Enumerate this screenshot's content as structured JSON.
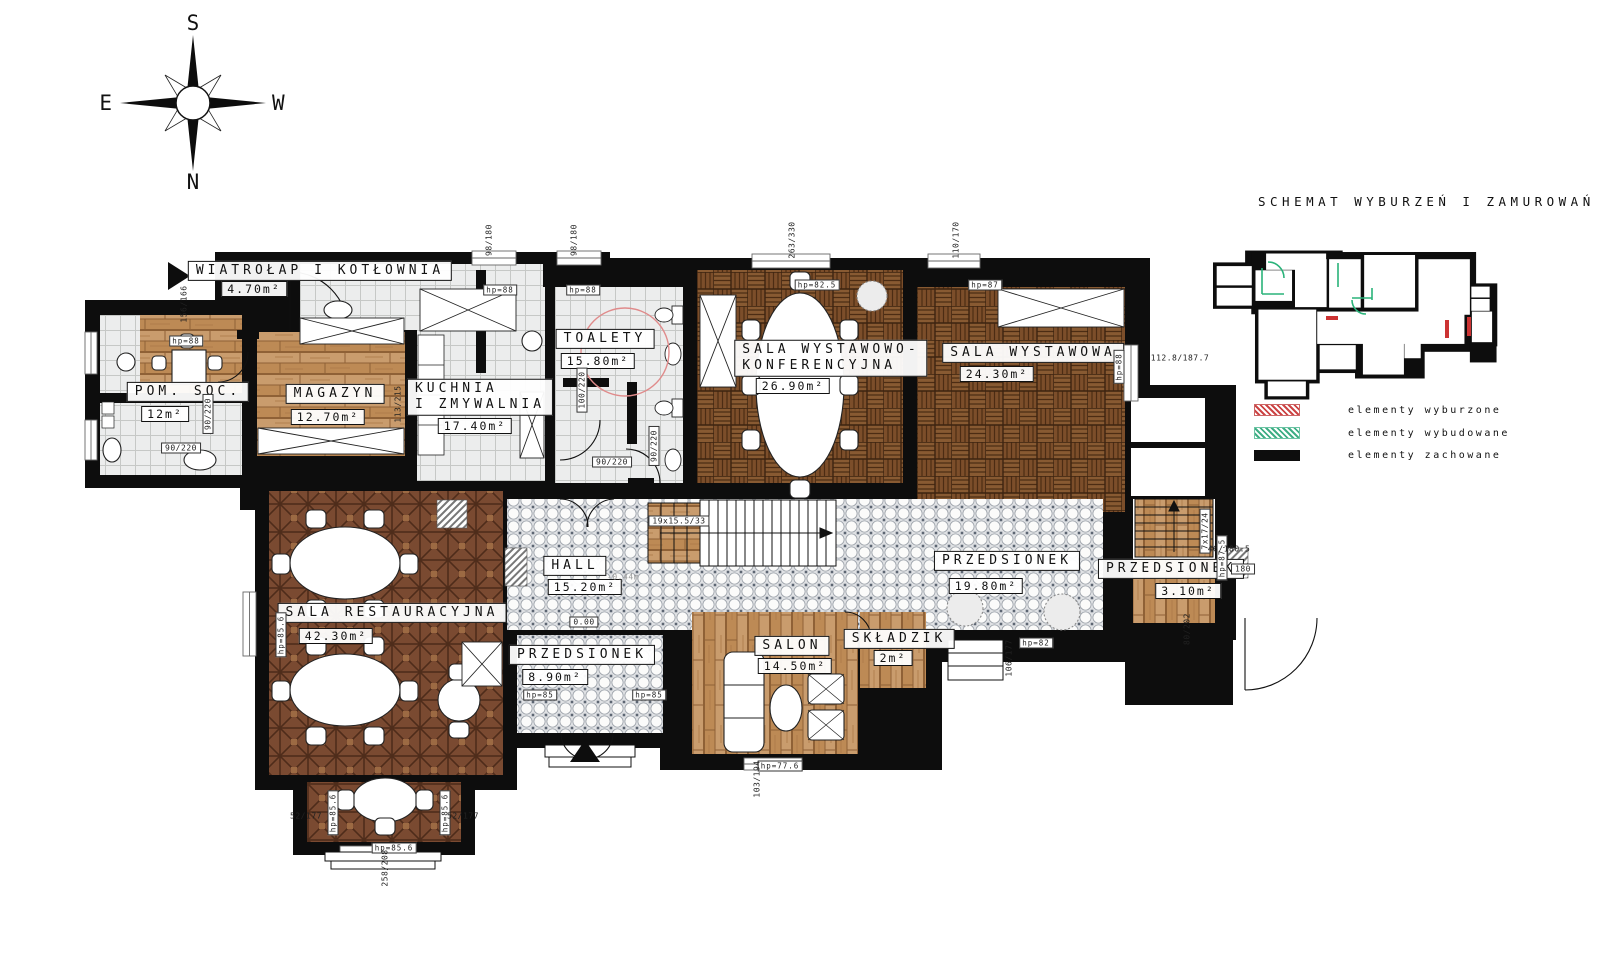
{
  "title": "SCHEMAT WYBURZEŃ I ZAMUROWAŃ",
  "compass": {
    "top": "S",
    "bottom": "N",
    "left": "E",
    "right": "W"
  },
  "legend": {
    "items": [
      {
        "label": "elementy wyburzone",
        "color": "#cc4444",
        "style": "hatch"
      },
      {
        "label": "elementy wybudowane",
        "color": "#3fae85",
        "style": "hatch"
      },
      {
        "label": "elementy zachowane",
        "color": "#0d0d0d",
        "style": "solid"
      }
    ]
  },
  "rooms": {
    "wiatrolap": {
      "name": "WIATROŁAP I KOTŁOWNIA",
      "area": "4.70m²"
    },
    "pomsoc": {
      "name": "POM. SOC.",
      "area": "12m²"
    },
    "magazyn": {
      "name": "MAGAZYN",
      "area": "12.70m²"
    },
    "kuchnia": {
      "line1": "KUCHNIA",
      "line2": "I ZMYWALNIA",
      "area": "17.40m²"
    },
    "toalety": {
      "name": "TOALETY",
      "area": "15.80m²"
    },
    "konferencyjna": {
      "line1": "SALA WYSTAWOWO-",
      "line2": "KONFERENCYJNA",
      "area": "26.90m²"
    },
    "wystawowa": {
      "name": "SALA WYSTAWOWA",
      "area": "24.30m²"
    },
    "restauracyjna": {
      "name": "SALA RESTAURACYJNA",
      "area": "42.30m²"
    },
    "hall": {
      "name": "HALL",
      "area": "15.20m²"
    },
    "przedsionek1": {
      "name": "PRZEDSIONEK",
      "area": "8.90m²"
    },
    "salon": {
      "name": "SALON",
      "area": "14.50m²"
    },
    "skladzik": {
      "name": "SKŁADZIK",
      "area": "2m²"
    },
    "przedsionek2": {
      "name": "PRZEDSIONEK",
      "area": "19.80m²"
    },
    "przedsionek3": {
      "name": "PRZEDSIONEK",
      "area": "3.10m²"
    }
  },
  "hp": [
    "hp=88",
    "hp=88",
    "hp=88",
    "hp=82.5",
    "hp=87",
    "hp=88",
    "hp=85.6",
    "hp=85.6",
    "hp=85.6",
    "hp=85.6",
    "hp=85",
    "hp=85",
    "hp=82",
    "hp=77.6",
    "hp=87.5"
  ],
  "dims": [
    "156/166",
    "98/180",
    "98/180",
    "263/330",
    "110/170",
    "112.8/187.7",
    "90/220",
    "90/220",
    "113/215",
    "100/220",
    "90/220",
    "90/220",
    "19x15.5/33",
    "0.00",
    "-0.44m",
    "52/177",
    "52/177",
    "258/208",
    "103/194",
    "106/177",
    "7x17/24",
    "180",
    "46/180.5",
    "80/202"
  ]
}
